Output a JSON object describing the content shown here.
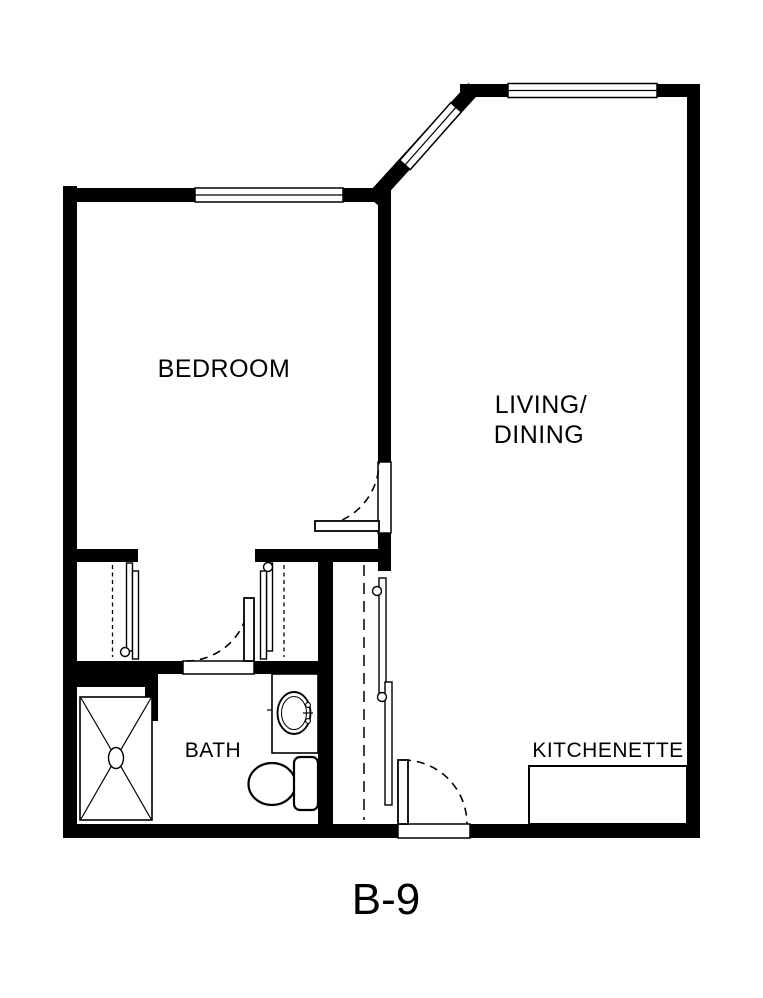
{
  "plan": {
    "code": "B-9",
    "colors": {
      "wall": "#000000",
      "background": "#ffffff"
    },
    "rooms": {
      "bedroom": {
        "label": "BEDROOM"
      },
      "living_dining": {
        "line1": "LIVING/",
        "line2": "DINING"
      },
      "bath": {
        "label": "BATH"
      },
      "kitchenette": {
        "label": "KITCHENETTE"
      }
    },
    "fixtures": {
      "shower": "shower-stall",
      "sink": "bathroom-sink",
      "toilet": "toilet",
      "kitchenette_counter": "kitchenette-counter"
    },
    "doors": [
      "bedroom-door",
      "bath-door",
      "entry-door"
    ],
    "closets": [
      "bedroom-closet-left",
      "bedroom-closet-right",
      "hall-closet"
    ],
    "windows": [
      "bedroom-window",
      "angled-corner-window",
      "living-room-window"
    ]
  }
}
